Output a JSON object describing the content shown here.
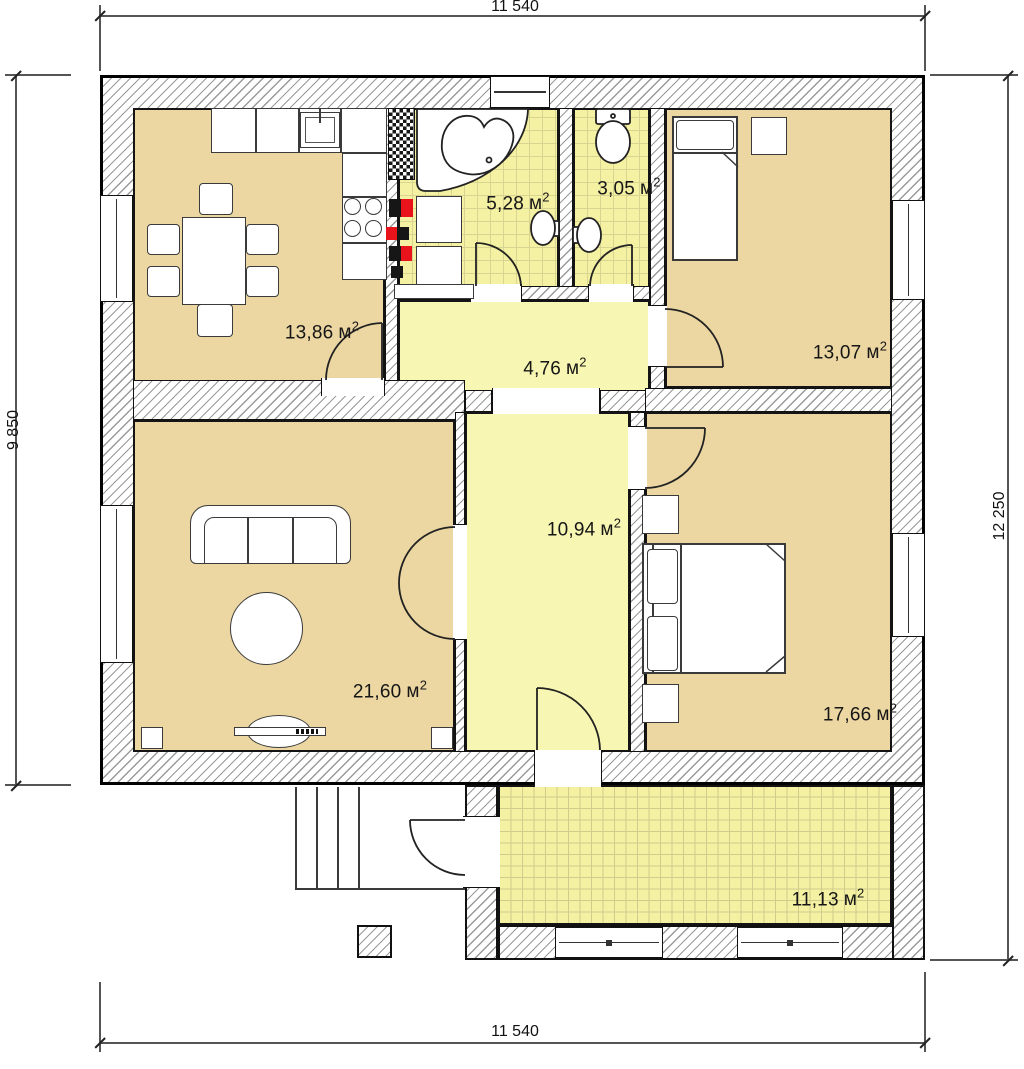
{
  "dimensions": {
    "top": "11 540",
    "bottom": "11 540",
    "left": "9 850",
    "right": "12 250"
  },
  "unit": {
    "symbol": "м",
    "sup": "2"
  },
  "rooms": [
    {
      "id": "kitchen",
      "area": "13,86"
    },
    {
      "id": "bathroom",
      "area": "5,28"
    },
    {
      "id": "wc",
      "area": "3,05"
    },
    {
      "id": "bedroom-2",
      "area": "13,07"
    },
    {
      "id": "hallway",
      "area": "4,76"
    },
    {
      "id": "corridor",
      "area": "10,94"
    },
    {
      "id": "living-room",
      "area": "21,60"
    },
    {
      "id": "bedroom-1",
      "area": "17,66"
    },
    {
      "id": "terrace",
      "area": "11,13"
    }
  ],
  "colors": {
    "room_tan": "#ecd7a3",
    "room_yellow": "#f7f6b3",
    "tile_yellow": "#f5f1a2",
    "duct_red": "#e8131b",
    "duct_black": "#161616",
    "wall_line": "#111111"
  }
}
